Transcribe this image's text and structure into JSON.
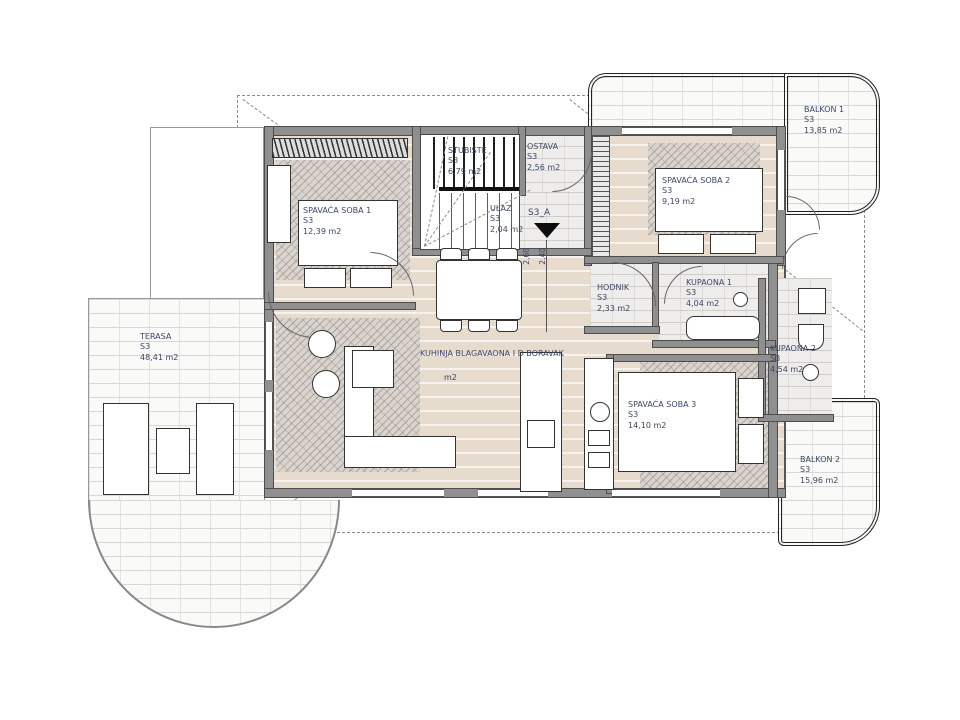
{
  "plan": {
    "title": "apartment-floor-plan",
    "colors": {
      "floor": "#e7dbce",
      "wall": "#8f8f8f",
      "label": "#3c4766",
      "outline": "#222222"
    }
  },
  "rooms": [
    {
      "name": "SPAVAĆA SOBA 1",
      "code": "S3",
      "area": "12,39 m2"
    },
    {
      "name": "SPAVAĆA SOBA 2",
      "code": "S3",
      "area": "9,19 m2"
    },
    {
      "name": "SPAVAĆA SOBA 3",
      "code": "S3",
      "area": "14,10 m2"
    },
    {
      "name": "STUBIŠTE",
      "code": "S3",
      "area": "6,79 m2"
    },
    {
      "name": "OSTAVA",
      "code": "S3",
      "area": "2,56 m2"
    },
    {
      "name": "ULAZ",
      "code": "S3",
      "area": "2,04 m2"
    },
    {
      "name": "HODNIK",
      "code": "S3",
      "area": "2,33 m2"
    },
    {
      "name": "KUPAONA 1",
      "code": "S3",
      "area": "4,04 m2"
    },
    {
      "name": "KUPAONA 2",
      "code": "S3",
      "area": "4,54 m2"
    },
    {
      "name": "KUHINJA BLAGAVAONA I D BORAVAK",
      "code": "",
      "area": "m2"
    },
    {
      "name": "TERASA",
      "code": "S3",
      "area": "48,41 m2"
    },
    {
      "name": "BALKON 1",
      "code": "S3",
      "area": "13,85 m2"
    },
    {
      "name": "BALKON 2",
      "code": "S3",
      "area": "15,96 m2"
    }
  ],
  "markers": {
    "section_label": "S3_A",
    "dim_left": "2,60",
    "dim_right": "2,40"
  }
}
